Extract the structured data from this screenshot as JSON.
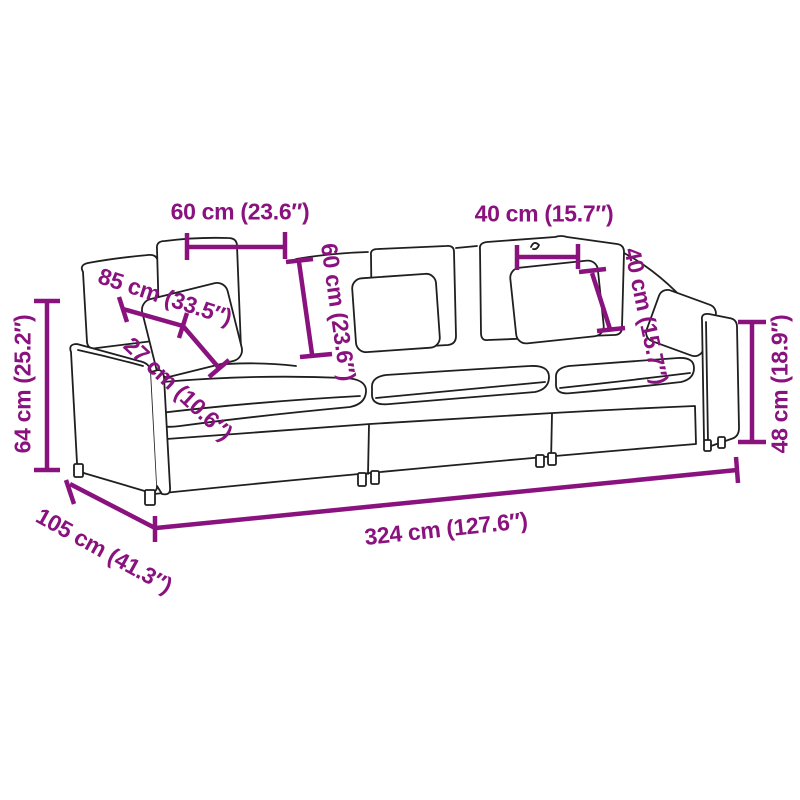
{
  "diagram": {
    "subject": "3-seater modular sofa line drawing with dimension annotations",
    "colors": {
      "dimension_accent": "#8A127F",
      "outline": "#1F1F1F",
      "background": "#FFFFFF"
    },
    "measurements": {
      "back_cushion_width": "60 cm (23.6″)",
      "backrest_height": "60 cm (23.6″)",
      "pillow_width": "40 cm (15.7″)",
      "pillow_height": "40 cm (15.7″)",
      "seat_depth": "85 cm (33.5″)",
      "seat_cushion_thickness": "27 cm (10.6″)",
      "overall_height": "64 cm (25.2″)",
      "armrest_height": "48 cm (18.9″)",
      "overall_depth": "105 cm (41.3″)",
      "overall_width": "324 cm (127.6″)"
    }
  }
}
